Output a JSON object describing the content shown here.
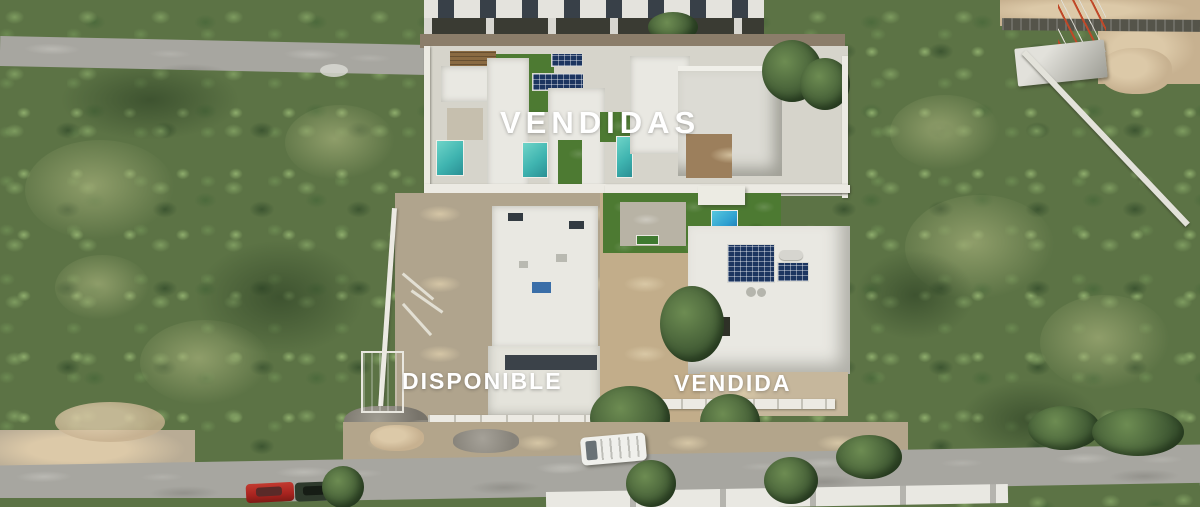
{
  "overlays": {
    "vendidas_label": "VENDIDAS",
    "disponible_label": "DISPONIBLE",
    "vendida_label": "VENDIDA"
  },
  "palette": {
    "label_text": "#ffffff",
    "vegetation": "#5c7345",
    "vegetation_dark": "#3c5531",
    "roof_white": "#e9e8e2",
    "pool_teal": "#3fb4b0",
    "pool_blue": "#2d9fd0",
    "solar_navy": "#1c3560",
    "lawn_green": "#4d7a32",
    "road_gray": "#a7a6a0",
    "street_dirt": "#8b7d6a",
    "sand_tan": "#c7b190",
    "dirt_tan": "#c2ad8a",
    "pergola_brown": "#8a6a42",
    "cistern_teal": "#4a9a94",
    "stone_wall": "#55544a",
    "tower_red": "#c04828",
    "car_red": "#a8231f",
    "car_dark_green": "#2e3a2c",
    "van_white": "#f0f0ec"
  },
  "scene": {
    "description": "Aerial drone photo of a residential development: a row of sold villas with pools and rooftop solar panels behind townhouses under construction, one available lot under construction and one sold modern house in front, surrounded by green scrubland and unpaved roads with parked cars."
  }
}
